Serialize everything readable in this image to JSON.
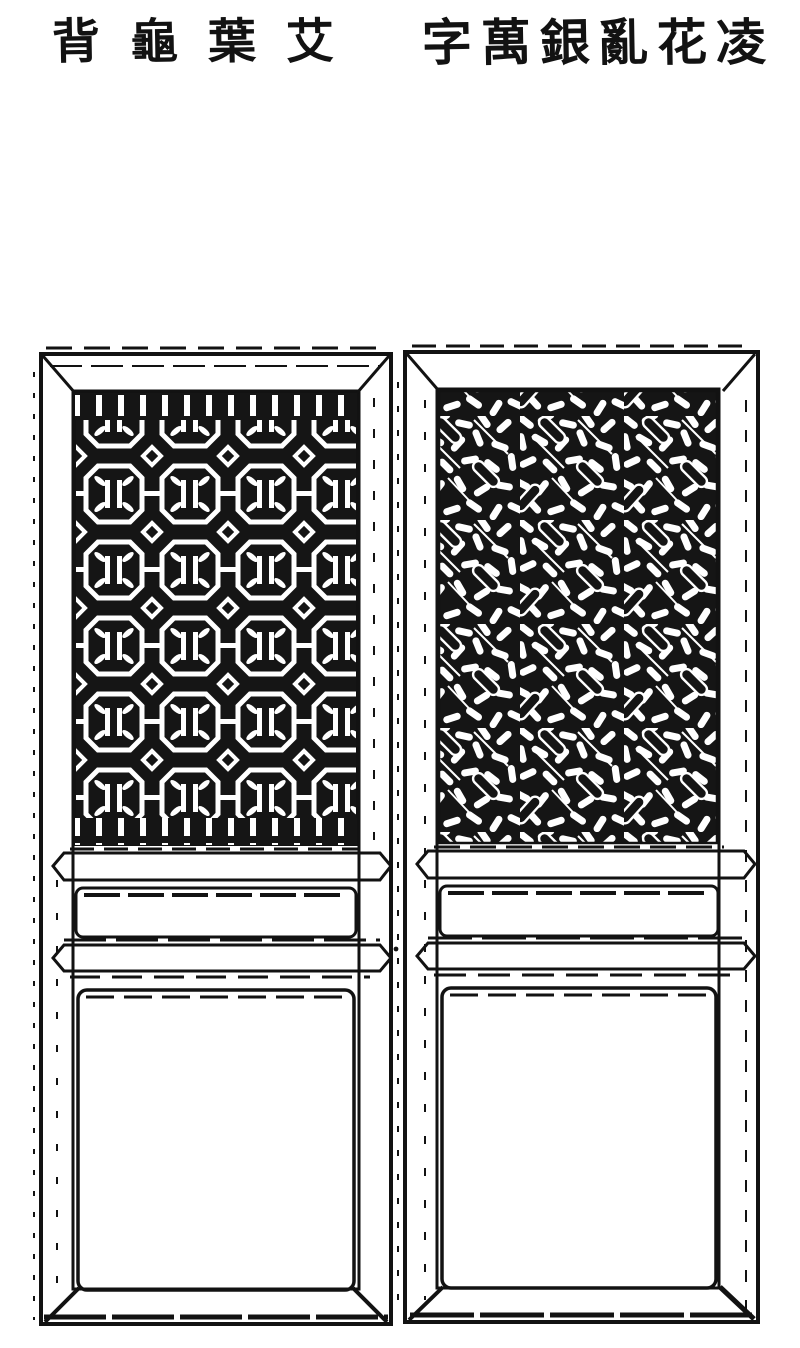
{
  "colors": {
    "paper": "#ffffff",
    "ink": "#121212"
  },
  "header": {
    "left_title": {
      "chars": [
        "背",
        "龜",
        "葉",
        "艾"
      ],
      "text_right_to_left": "艾葉龜背"
    },
    "right_title": {
      "chars": [
        "字",
        "萬",
        "銀",
        "亂",
        "花",
        "凌"
      ],
      "text_right_to_left": "凌花亂銀萬字"
    }
  },
  "figure": {
    "left_door": {
      "label": "艾葉龜背",
      "lattice_pattern": "octagon tortoise-shell lattice with leaf motifs, white lines on black ground",
      "sections": "lattice panel / rail / small plain panel / rail / large plain panel"
    },
    "right_door": {
      "label": "凌花亂銀萬字",
      "lattice_pattern": "scattered silver-ingot and pebble weave lattice, white shapes on black ground",
      "sections": "lattice panel / rail / small plain panel / rail / large plain panel"
    }
  }
}
